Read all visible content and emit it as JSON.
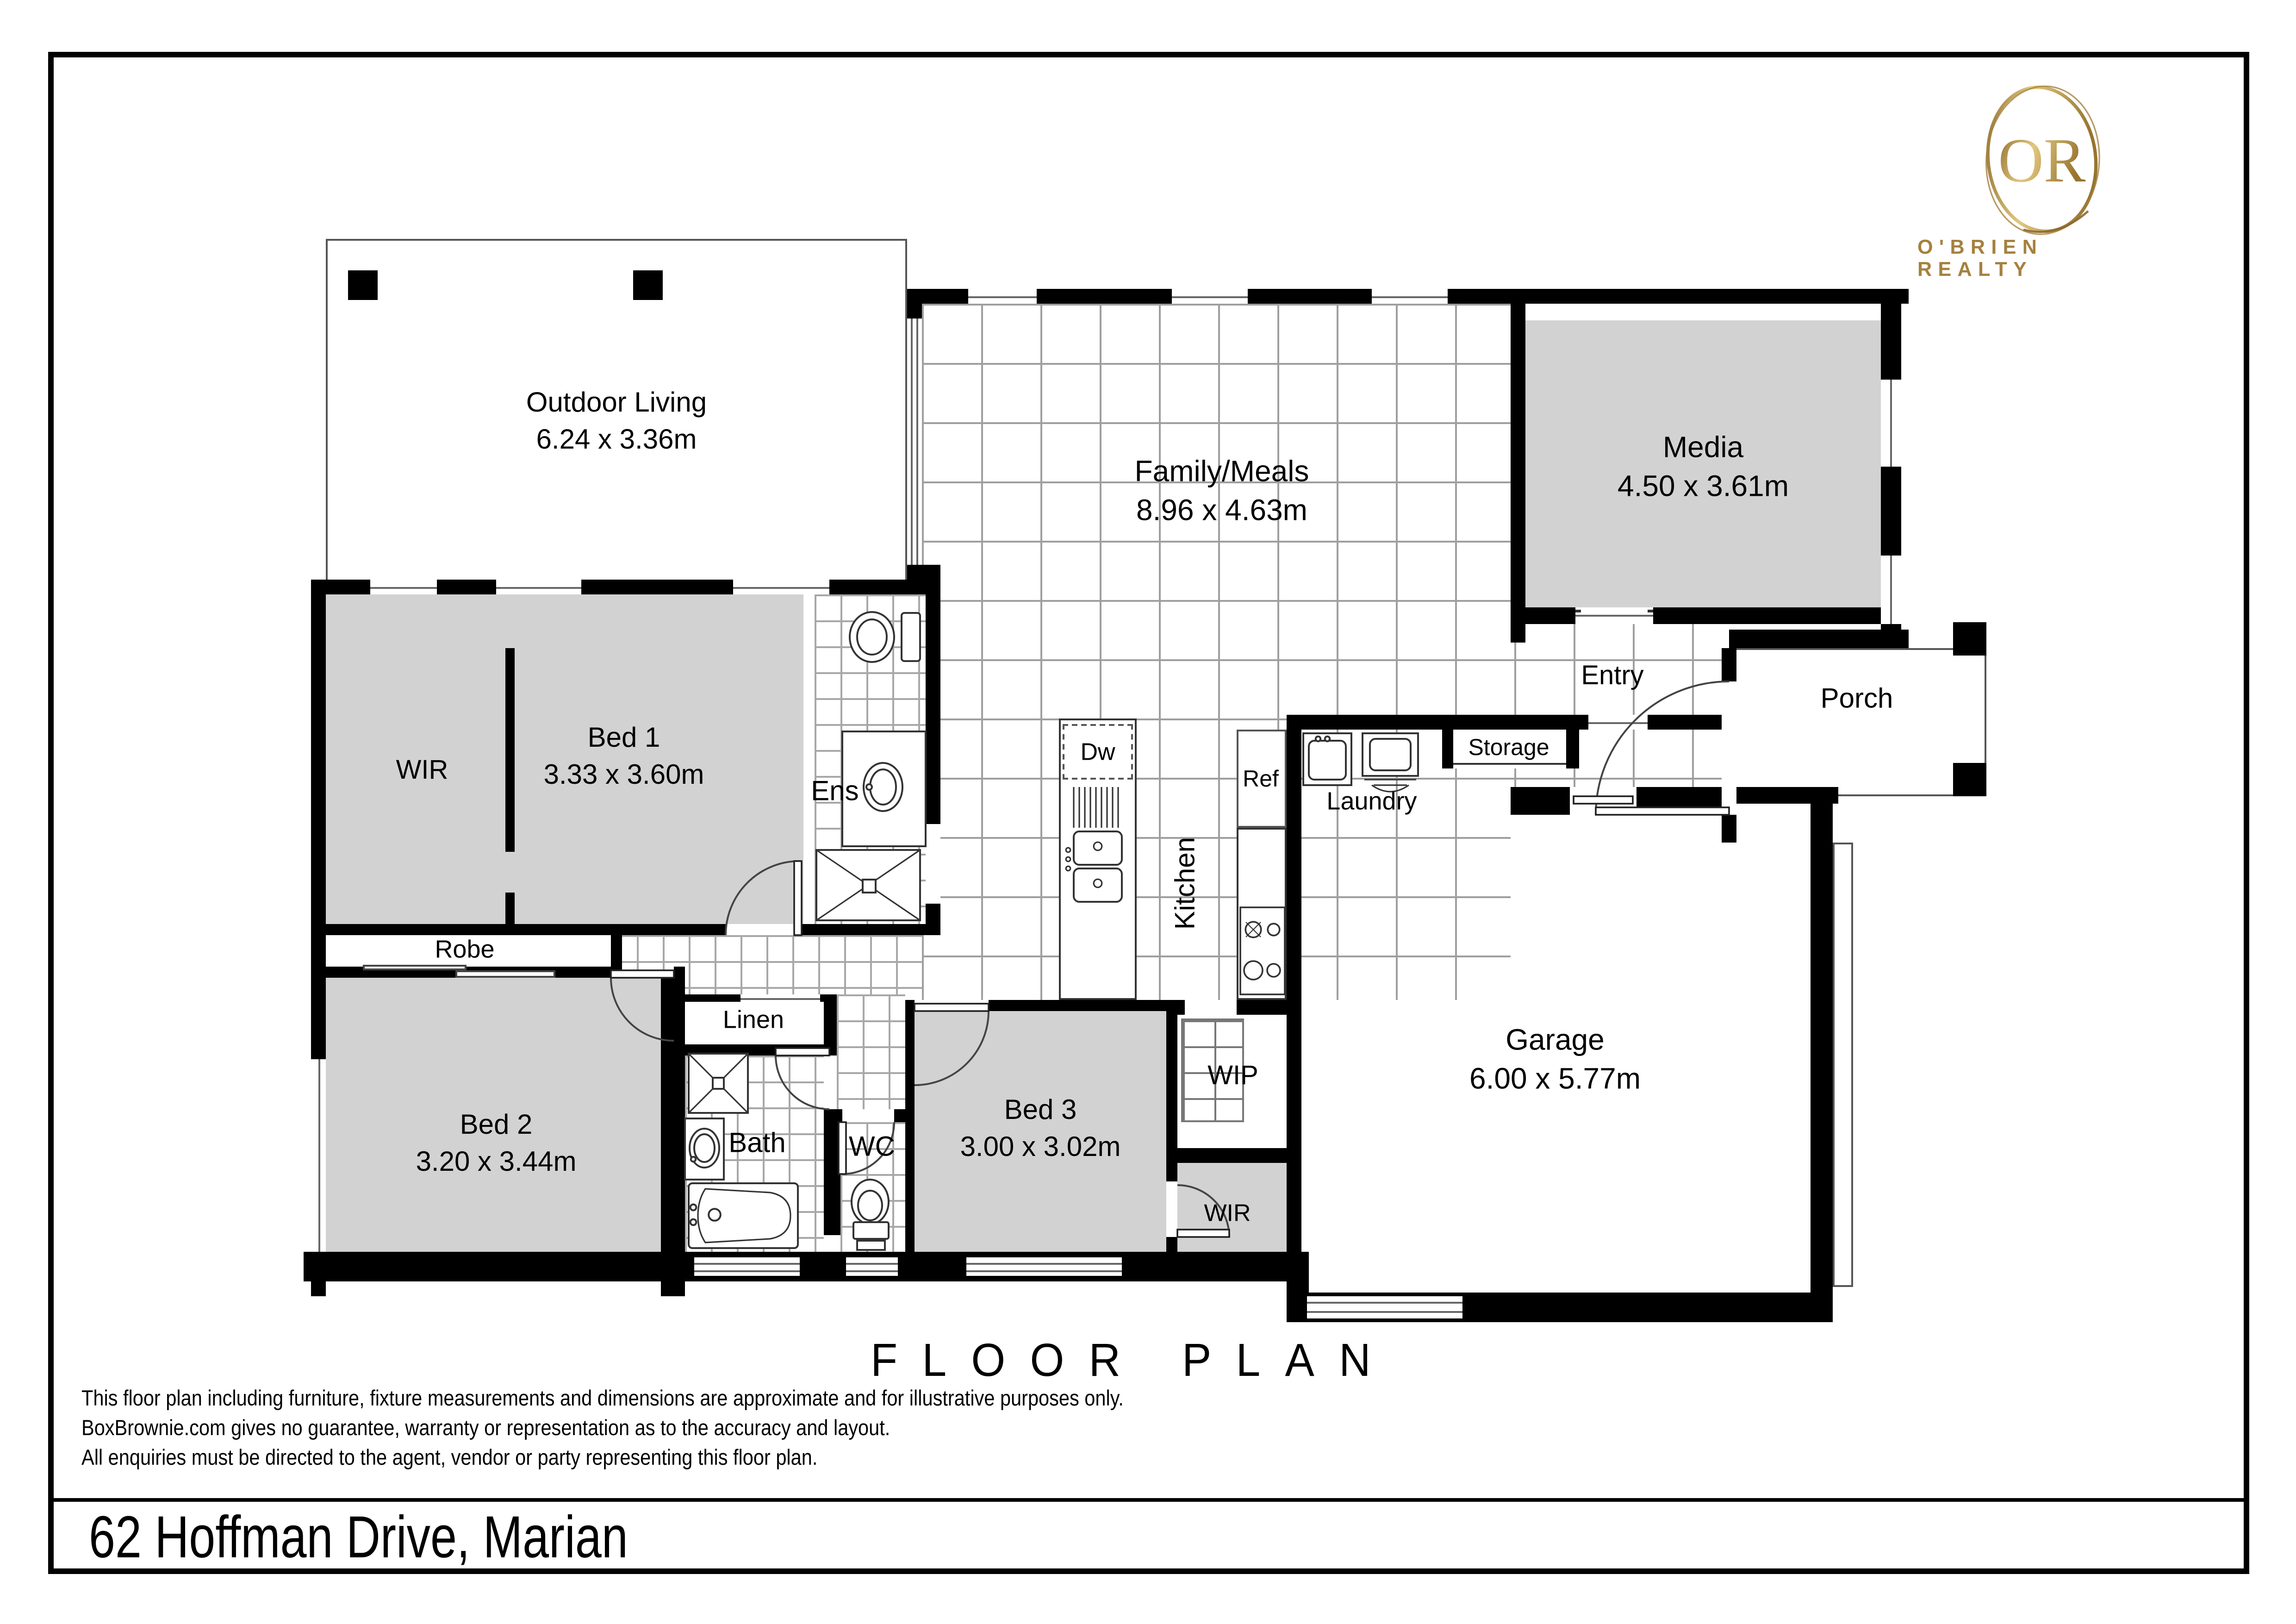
{
  "brand": {
    "monogram": "OR",
    "wordmark": "O'BRIEN REALTY"
  },
  "plan": {
    "title": "FLOOR PLAN"
  },
  "rooms": {
    "outdoor_living": {
      "name": "Outdoor Living",
      "dims": "6.24 x 3.36m"
    },
    "family_meals": {
      "name": "Family/Meals",
      "dims": "8.96 x 4.63m"
    },
    "media": {
      "name": "Media",
      "dims": "4.50 x 3.61m"
    },
    "entry": {
      "name": "Entry"
    },
    "porch": {
      "name": "Porch"
    },
    "wir_bed1": {
      "name": "WIR"
    },
    "bed1": {
      "name": "Bed 1",
      "dims": "3.33 x 3.60m"
    },
    "ens": {
      "name": "Ens"
    },
    "kitchen": {
      "name": "Kitchen"
    },
    "dw": {
      "name": "Dw"
    },
    "ref": {
      "name": "Ref"
    },
    "laundry": {
      "name": "Laundry"
    },
    "storage": {
      "name": "Storage"
    },
    "robe": {
      "name": "Robe"
    },
    "linen": {
      "name": "Linen"
    },
    "bed2": {
      "name": "Bed 2",
      "dims": "3.20 x 3.44m"
    },
    "bath": {
      "name": "Bath"
    },
    "wc": {
      "name": "WC"
    },
    "bed3": {
      "name": "Bed 3",
      "dims": "3.00 x 3.02m"
    },
    "wip": {
      "name": "WIP"
    },
    "wir_bed3": {
      "name": "WIR"
    },
    "garage": {
      "name": "Garage",
      "dims": "6.00 x 5.77m"
    }
  },
  "disclaimer": {
    "line1": "This floor plan including furniture, fixture measurements and dimensions are approximate and for illustrative purposes only.",
    "line2": "BoxBrownie.com gives no guarantee, warranty or representation as to the accuracy and layout.",
    "line3": "All enquiries must be directed to the agent, vendor or party representing this floor plan."
  },
  "address": "62 Hoffman Drive, Marian",
  "colors": {
    "wall": "#000000",
    "carpet": "#d2d2d2",
    "gold": "#a5813f"
  }
}
